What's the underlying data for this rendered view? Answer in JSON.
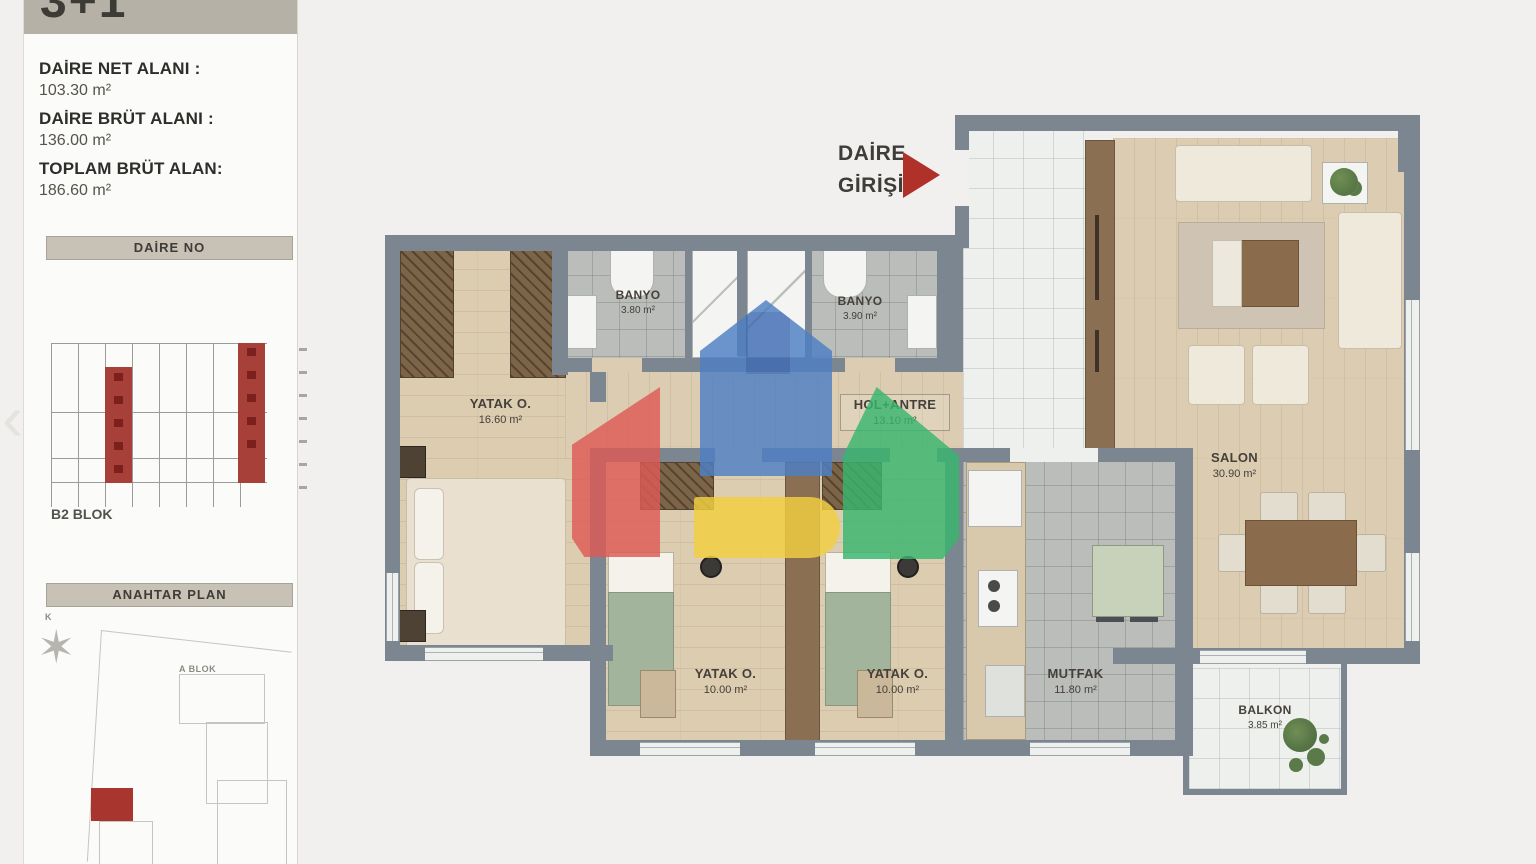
{
  "page": {
    "background": "#f1f0ee"
  },
  "sidebar": {
    "plan_type": "3+1",
    "stats": [
      {
        "label": "DAİRE NET ALANI :",
        "value": "103.30 m²"
      },
      {
        "label": "DAİRE BRÜT ALANI :",
        "value": "136.00 m²"
      },
      {
        "label": "TOPLAM BRÜT ALAN:",
        "value": "186.60 m²"
      }
    ],
    "daire_no_title": "DAİRE NO",
    "block_label": "B2 BLOK",
    "anahtar_title": "ANAHTAR PLAN",
    "site": {
      "compass_label": "K",
      "block_a_label": "A BLOK"
    }
  },
  "plan": {
    "entrance": {
      "line1": "DAİRE",
      "line2": "GİRİŞİ"
    },
    "rooms": [
      {
        "id": "banyo-1",
        "name": "BANYO",
        "area": "3.80 m²"
      },
      {
        "id": "banyo-2",
        "name": "BANYO",
        "area": "3.90 m²"
      },
      {
        "id": "yatak-master",
        "name": "YATAK O.",
        "area": "16.60 m²"
      },
      {
        "id": "hol-antre",
        "name": "HOL+ANTRE",
        "area": "13.10 m²"
      },
      {
        "id": "salon",
        "name": "SALON",
        "area": "30.90 m²"
      },
      {
        "id": "yatak-a",
        "name": "YATAK O.",
        "area": "10.00 m²"
      },
      {
        "id": "yatak-b",
        "name": "YATAK O.",
        "area": "10.00 m²"
      },
      {
        "id": "mutfak",
        "name": "MUTFAK",
        "area": "11.80 m²"
      },
      {
        "id": "balkon",
        "name": "BALKON",
        "area": "3.85 m²"
      }
    ]
  },
  "colors": {
    "accent_red": "#b0302a",
    "wall_gray": "#7b8690",
    "wood_floor": "#dcccb0",
    "logo_blue": "#4d7fc4",
    "logo_red": "#dd5a55",
    "logo_green": "#37b66e",
    "logo_yellow": "#f2cf3f"
  },
  "icons": {
    "compass_glyph": "✶",
    "prev_arrow_glyph": "‹",
    "plant_glyph": "✳"
  }
}
